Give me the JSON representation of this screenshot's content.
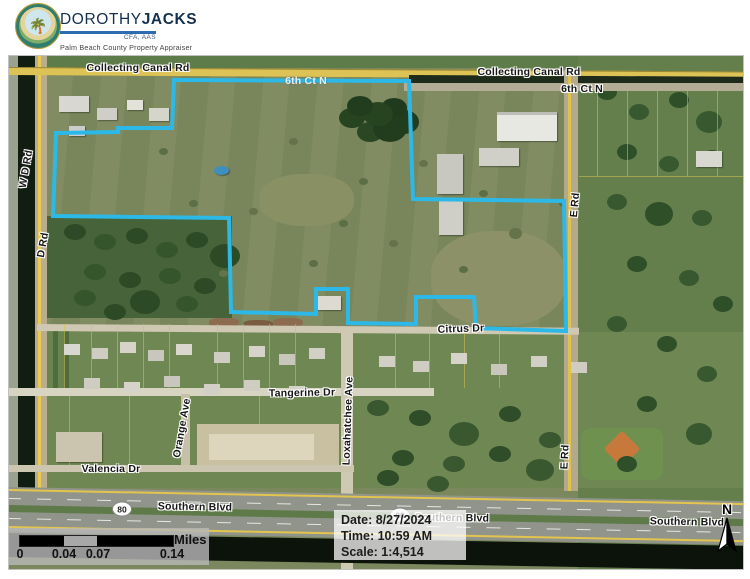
{
  "header": {
    "brand_first": "DOROTHY",
    "brand_last": "JACKS",
    "credentials": "CFA, AAS",
    "subtitle": "Palm Beach County Property Appraiser"
  },
  "map": {
    "parcel_outline_color": "#2cb9e8",
    "road_labels": {
      "collecting_canal_west": "Collecting Canal Rd",
      "collecting_canal_east": "Collecting Canal Rd",
      "sixth_ct_n": "6th Ct N",
      "sixth_ct_n_faint": "6th Ct N",
      "w_d_rd": "W D Rd",
      "d_rd": "D Rd",
      "e_rd_north": "E Rd",
      "e_rd_south": "E Rd",
      "citrus_dr": "Citrus Dr",
      "tangerine_dr": "Tangerine Dr",
      "loxahatchee_ave": "Loxahatchee Ave",
      "orange_ave": "Orange Ave",
      "valencia_dr": "Valencia Dr",
      "southern_blvd_west": "Southern Blvd",
      "southern_blvd_mid": "Southern Blvd",
      "southern_blvd_east": "Southern Blvd",
      "route_80": "80"
    },
    "info_box": {
      "date": "Date: 8/27/2024",
      "time": "Time: 10:59 AM",
      "scale": "Scale: 1:4,514"
    },
    "scale_bar": {
      "tick_0": "0",
      "tick_1": "0.04",
      "tick_2": "0.07",
      "tick_3": "0.14",
      "unit": "Miles"
    },
    "north_label": "N"
  }
}
